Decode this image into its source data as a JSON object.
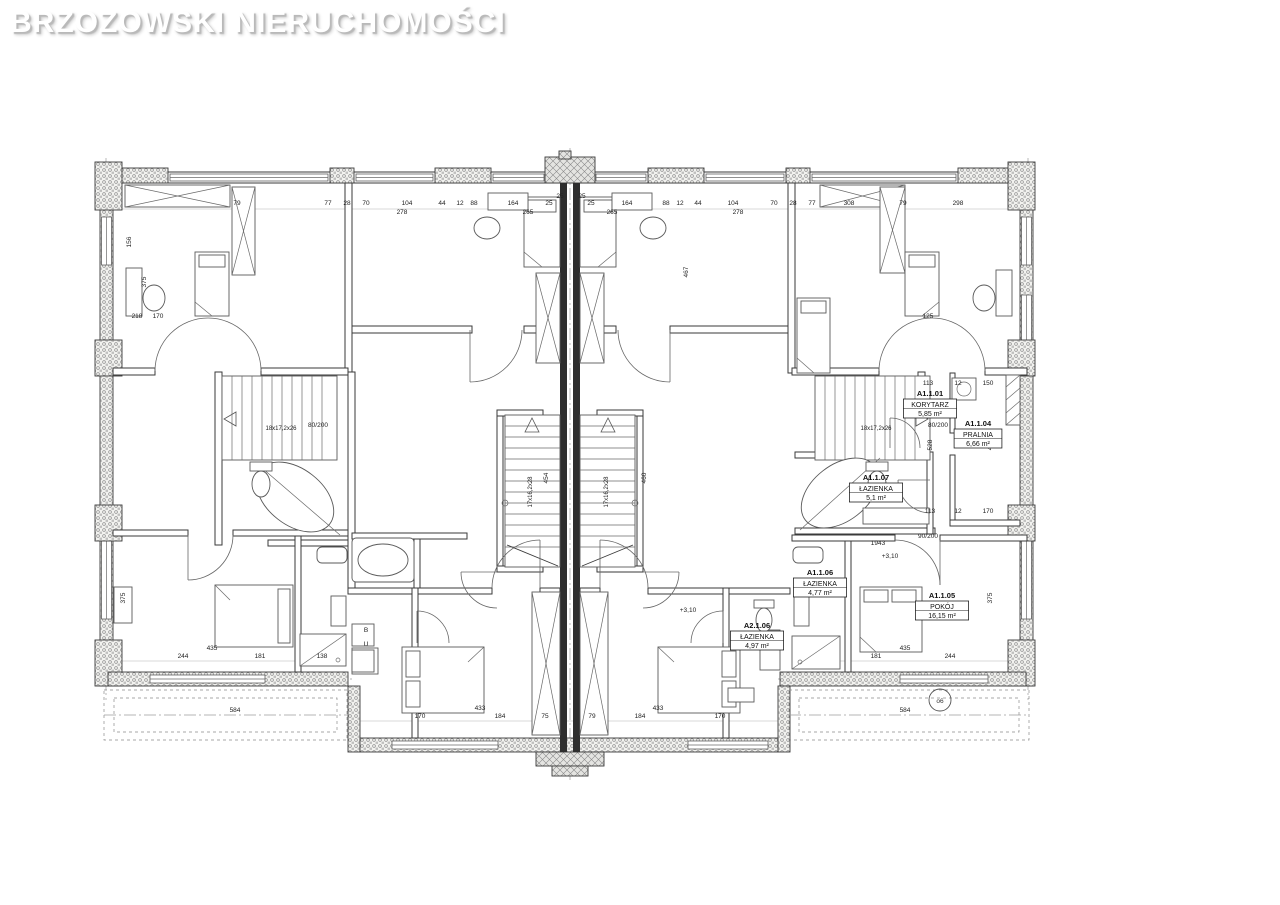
{
  "watermark": "BRZOZOWSKI NIERUCHOMOŚCI",
  "plan": {
    "room_labels": [
      {
        "id": "A1.1.01",
        "name": "KORYTARZ",
        "area": "5,85 m²",
        "x": 930,
        "y": 396
      },
      {
        "id": "A1.1.04",
        "name": "PRALNIA",
        "area": "6,66 m²",
        "x": 978,
        "y": 426
      },
      {
        "id": "A1.1.07",
        "name": "ŁAZIENKA",
        "area": "5,1 m²",
        "x": 876,
        "y": 480
      },
      {
        "id": "A1.1.06",
        "name": "ŁAZIENKA",
        "area": "4,77 m²",
        "x": 820,
        "y": 575
      },
      {
        "id": "A1.1.05",
        "name": "POKÓJ",
        "area": "16,15 m²",
        "x": 942,
        "y": 598
      },
      {
        "id": "A2.1.06",
        "name": "ŁAZIENKA",
        "area": "4,97 m²",
        "x": 757,
        "y": 628
      }
    ],
    "stair_labels": [
      {
        "x": 532,
        "y": 492,
        "t": "17x16,2x28",
        "r": -90
      },
      {
        "x": 608,
        "y": 492,
        "t": "17x16,2x28",
        "r": -90
      },
      {
        "x": 281,
        "y": 430,
        "t": "18x17,2x26",
        "r": 0
      },
      {
        "x": 876,
        "y": 430,
        "t": "18x17,2x26",
        "r": 0
      }
    ],
    "dimensions": [
      {
        "x": 237,
        "y": 205,
        "t": "79"
      },
      {
        "x": 328,
        "y": 205,
        "t": "77"
      },
      {
        "x": 347,
        "y": 205,
        "t": "28"
      },
      {
        "x": 366,
        "y": 205,
        "t": "70"
      },
      {
        "x": 407,
        "y": 205,
        "t": "104"
      },
      {
        "x": 442,
        "y": 205,
        "t": "44"
      },
      {
        "x": 460,
        "y": 205,
        "t": "12"
      },
      {
        "x": 474,
        "y": 205,
        "t": "88"
      },
      {
        "x": 513,
        "y": 205,
        "t": "164"
      },
      {
        "x": 549,
        "y": 205,
        "t": "25"
      },
      {
        "x": 591,
        "y": 205,
        "t": "25"
      },
      {
        "x": 627,
        "y": 205,
        "t": "164"
      },
      {
        "x": 666,
        "y": 205,
        "t": "88"
      },
      {
        "x": 680,
        "y": 205,
        "t": "12"
      },
      {
        "x": 698,
        "y": 205,
        "t": "44"
      },
      {
        "x": 733,
        "y": 205,
        "t": "104"
      },
      {
        "x": 774,
        "y": 205,
        "t": "70"
      },
      {
        "x": 793,
        "y": 205,
        "t": "28"
      },
      {
        "x": 812,
        "y": 205,
        "t": "77"
      },
      {
        "x": 849,
        "y": 205,
        "t": "308"
      },
      {
        "x": 903,
        "y": 205,
        "t": "79"
      },
      {
        "x": 958,
        "y": 205,
        "t": "298"
      },
      {
        "x": 402,
        "y": 214,
        "t": "278"
      },
      {
        "x": 528,
        "y": 214,
        "t": "265"
      },
      {
        "x": 612,
        "y": 214,
        "t": "265"
      },
      {
        "x": 738,
        "y": 214,
        "t": "278"
      },
      {
        "x": 131,
        "y": 242,
        "t": "156",
        "r": -90
      },
      {
        "x": 146,
        "y": 282,
        "t": "375",
        "r": -90
      },
      {
        "x": 932,
        "y": 445,
        "t": "528",
        "r": -90
      },
      {
        "x": 992,
        "y": 445,
        "t": "411",
        "r": -90
      },
      {
        "x": 992,
        "y": 598,
        "t": "375",
        "r": -90
      },
      {
        "x": 125,
        "y": 598,
        "t": "375",
        "r": -90
      },
      {
        "x": 548,
        "y": 478,
        "t": "454",
        "r": -90
      },
      {
        "x": 646,
        "y": 478,
        "t": "460",
        "r": -90
      },
      {
        "x": 688,
        "y": 272,
        "t": "467",
        "r": -90
      },
      {
        "x": 137,
        "y": 318,
        "t": "218"
      },
      {
        "x": 158,
        "y": 318,
        "t": "170"
      },
      {
        "x": 928,
        "y": 318,
        "t": "125"
      },
      {
        "x": 928,
        "y": 385,
        "t": "113"
      },
      {
        "x": 958,
        "y": 385,
        "t": "12"
      },
      {
        "x": 988,
        "y": 385,
        "t": "150"
      },
      {
        "x": 930,
        "y": 513,
        "t": "113"
      },
      {
        "x": 958,
        "y": 513,
        "t": "12"
      },
      {
        "x": 988,
        "y": 513,
        "t": "170"
      },
      {
        "x": 183,
        "y": 658,
        "t": "244"
      },
      {
        "x": 260,
        "y": 658,
        "t": "181"
      },
      {
        "x": 322,
        "y": 658,
        "t": "138"
      },
      {
        "x": 876,
        "y": 658,
        "t": "181"
      },
      {
        "x": 950,
        "y": 658,
        "t": "244"
      },
      {
        "x": 212,
        "y": 650,
        "t": "435"
      },
      {
        "x": 905,
        "y": 650,
        "t": "435"
      },
      {
        "x": 420,
        "y": 718,
        "t": "170"
      },
      {
        "x": 500,
        "y": 718,
        "t": "184"
      },
      {
        "x": 545,
        "y": 718,
        "t": "75"
      },
      {
        "x": 592,
        "y": 718,
        "t": "79"
      },
      {
        "x": 640,
        "y": 718,
        "t": "184"
      },
      {
        "x": 720,
        "y": 718,
        "t": "170"
      },
      {
        "x": 480,
        "y": 710,
        "t": "433"
      },
      {
        "x": 658,
        "y": 710,
        "t": "433"
      },
      {
        "x": 235,
        "y": 712,
        "t": "584"
      },
      {
        "x": 905,
        "y": 712,
        "t": "584"
      },
      {
        "x": 890,
        "y": 558,
        "t": "+3,10"
      },
      {
        "x": 688,
        "y": 612,
        "t": "+3,10"
      },
      {
        "x": 878,
        "y": 545,
        "t": "1943"
      },
      {
        "x": 938,
        "y": 427,
        "t": "80/200"
      },
      {
        "x": 928,
        "y": 538,
        "t": "90/200"
      },
      {
        "x": 318,
        "y": 427,
        "t": "80/200"
      },
      {
        "x": 366,
        "y": 632,
        "t": "B"
      },
      {
        "x": 366,
        "y": 646,
        "t": "U"
      },
      {
        "x": 560,
        "y": 198,
        "t": "25"
      },
      {
        "x": 582,
        "y": 198,
        "t": "25"
      }
    ],
    "marker": {
      "x": 940,
      "y": 704,
      "t": "o6"
    },
    "colors": {
      "line": "#3a3a3a",
      "hatch": "#8f8f8f",
      "axis": "#9c9c9c"
    }
  }
}
